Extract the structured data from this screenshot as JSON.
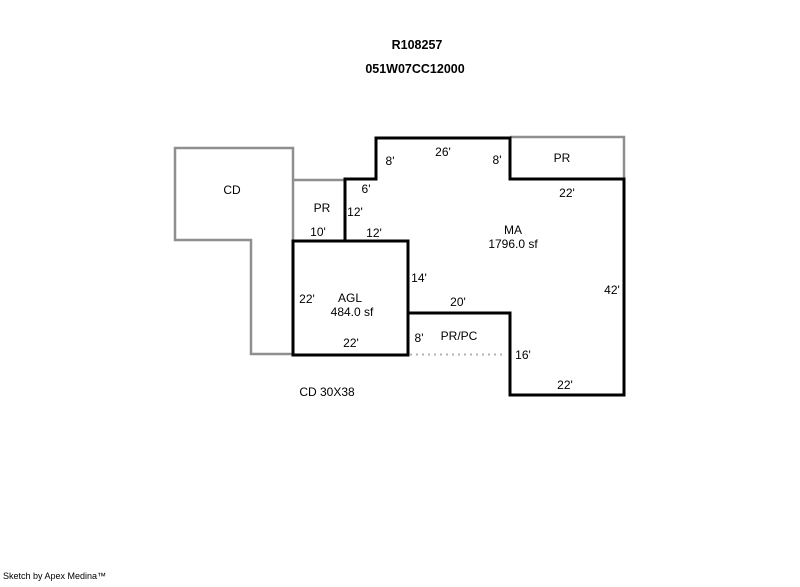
{
  "header": {
    "line1": "R108257",
    "line2": "051W07CC12000"
  },
  "areas": {
    "cd": {
      "label": "CD"
    },
    "pr_left": {
      "label": "PR"
    },
    "pr_right": {
      "label": "PR"
    },
    "ma": {
      "label": "MA",
      "sqft": "1796.0 sf"
    },
    "agl": {
      "label": "AGL",
      "sqft": "484.0 sf"
    },
    "prpc": {
      "label": "PR/PC"
    }
  },
  "dims": {
    "top_left_8": "8'",
    "top_26": "26'",
    "top_right_8": "8'",
    "pr_right_22": "22'",
    "notch_6": "6'",
    "notch_12_v": "12'",
    "notch_12_h": "12'",
    "pr_left_10": "10'",
    "agl_left_22": "22'",
    "agl_right_14": "14'",
    "agl_bottom_22": "22'",
    "prpc_top_20": "20'",
    "prpc_left_8": "8'",
    "prpc_right_16": "16'",
    "right_42": "42'",
    "bottom_22": "22'"
  },
  "notes": {
    "cd_size": "CD 30X38"
  },
  "footer": {
    "credit": "Sketch by Apex Medina™"
  },
  "colors": {
    "outline": "#000000",
    "secondary_outline": "#8f8f8f",
    "dotted_line": "#b3b3b3",
    "background": "#ffffff"
  }
}
